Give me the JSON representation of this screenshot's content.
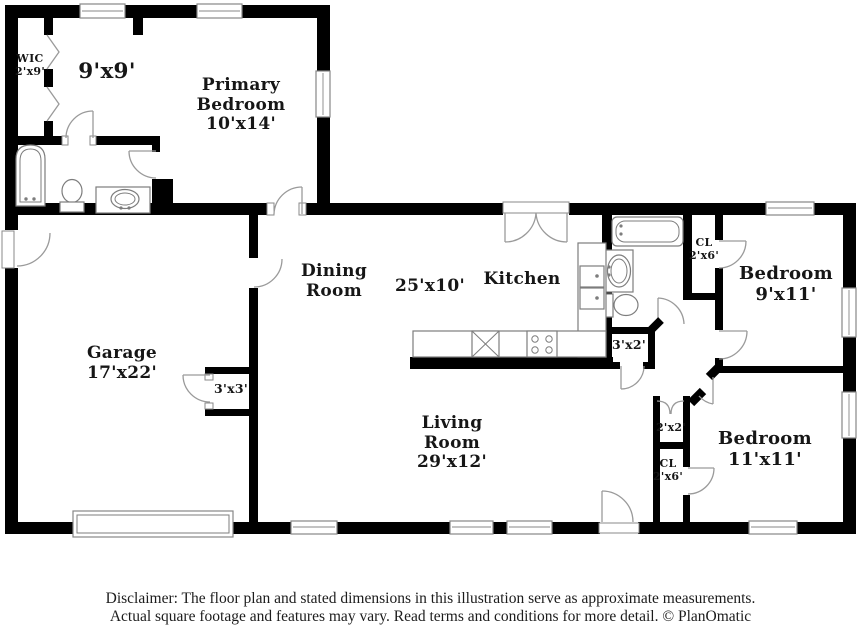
{
  "labels": {
    "wic": {
      "l1": "WIC",
      "l2": "2'x9'"
    },
    "dressing": {
      "l1": "9'x9'"
    },
    "primary_bedroom": {
      "l1": "Primary",
      "l2": "Bedroom",
      "l3": "10'x14'"
    },
    "dining_room": {
      "l1": "Dining",
      "l2": "Room"
    },
    "dining_dims": {
      "l1": "25'x10'"
    },
    "kitchen": {
      "l1": "Kitchen"
    },
    "cl_top": {
      "l1": "CL",
      "l2": "2'x6'"
    },
    "bedroom_9x11": {
      "l1": "Bedroom",
      "l2": "9'x11'"
    },
    "linen_3x2": {
      "l1": "3'x2'"
    },
    "garage": {
      "l1": "Garage",
      "l2": "17'x22'"
    },
    "closet_3x3": {
      "l1": "3'x3'"
    },
    "living_room": {
      "l1": "Living",
      "l2": "Room",
      "l3": "29'x12'"
    },
    "closet_2x2": {
      "l1": "2'x2'"
    },
    "cl_bottom": {
      "l1": "CL",
      "l2": "2'x6'"
    },
    "bedroom_11x11": {
      "l1": "Bedroom",
      "l2": "11'x11'"
    }
  },
  "disclaimer": {
    "line1": "Disclaimer: The floor plan and stated dimensions in this illustration serve as approximate measurements.",
    "line2": "Actual square footage and features may vary. Read terms and conditions for more detail. © PlanOmatic"
  },
  "colors": {
    "wall": "#000000",
    "background": "#ffffff",
    "fixture_line": "#7d7d7d",
    "door_swing": "#9a9a9a",
    "text": "#161616"
  }
}
